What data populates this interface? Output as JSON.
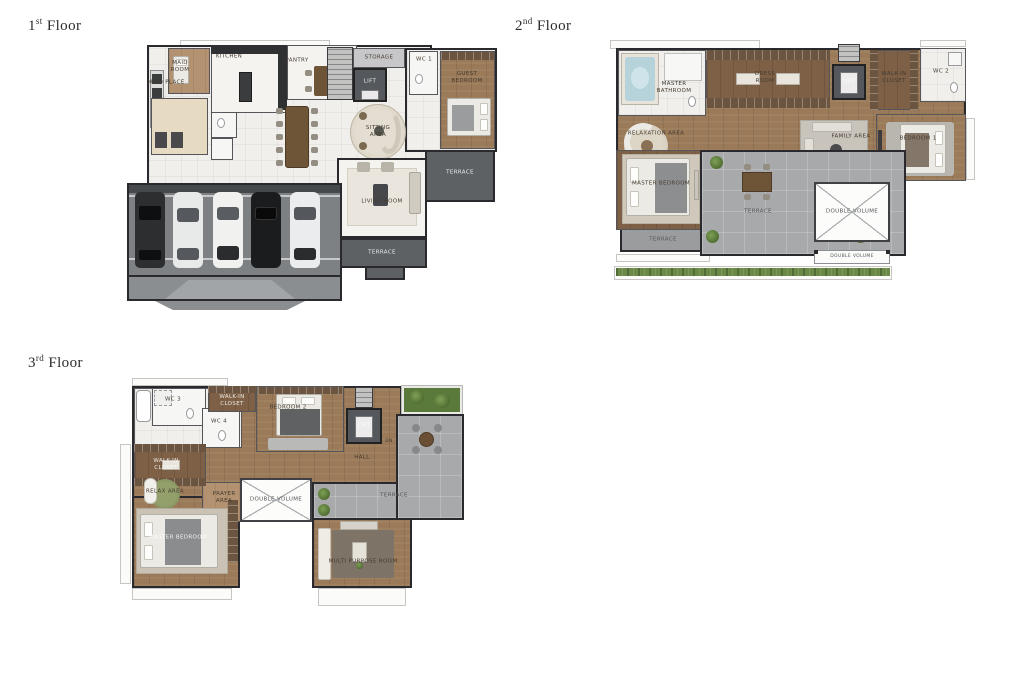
{
  "colors": {
    "background": "#ffffff",
    "wall": "#2a2a2e",
    "wood_floor": "#9a7a58",
    "wood_dark": "#7d6045",
    "tile_floor": "#f0efeb",
    "terrace_dark": "#5d6164",
    "terrace_light": "#a7a9ab",
    "road": "#7e8184",
    "greenery": "#6b8947",
    "jacuzzi_water": "#b6d3dc"
  },
  "floors": [
    {
      "title": {
        "number": "1",
        "ordinal": "st",
        "word": "Floor"
      },
      "rooms": [
        {
          "label": "MAID ROOM"
        },
        {
          "label": "KITCHEN"
        },
        {
          "label": "PANTRY"
        },
        {
          "label": "MAID PLACE"
        },
        {
          "label": "STORAGE"
        },
        {
          "label": "LIFT"
        },
        {
          "label": "WC 1"
        },
        {
          "label": "GUEST BEDROOM"
        },
        {
          "label": "TERRACE"
        },
        {
          "label": "SITTING AREA"
        },
        {
          "label": "LIVING ROOM"
        },
        {
          "label": "TERRACE"
        }
      ]
    },
    {
      "title": {
        "number": "2",
        "ordinal": "nd",
        "word": "Floor"
      },
      "rooms": [
        {
          "label": "MASTER BATHROOM"
        },
        {
          "label": "DRESS ROOM"
        },
        {
          "label": "LIFT"
        },
        {
          "label": "WALK-IN CLOSET"
        },
        {
          "label": "WC 2"
        },
        {
          "label": "BEDROOM 1"
        },
        {
          "label": "FAMILY AREA"
        },
        {
          "label": "RELAXATION AREA"
        },
        {
          "label": "MASTER BEDROOM"
        },
        {
          "label": "TERRACE"
        },
        {
          "label": "TERRACE"
        },
        {
          "label": "DOUBLE VOLUME"
        },
        {
          "label": "DOUBLE VOLUME"
        }
      ]
    },
    {
      "title": {
        "number": "3",
        "ordinal": "rd",
        "word": "Floor"
      },
      "rooms": [
        {
          "label": "WC 3"
        },
        {
          "label": "WC 4"
        },
        {
          "label": "WALK-IN CLOSET"
        },
        {
          "label": "BEDROOM 2"
        },
        {
          "label": "LIFT"
        },
        {
          "label": "DN"
        },
        {
          "label": "TERRACE"
        },
        {
          "label": "HALL"
        },
        {
          "label": "PRAYER AREA"
        },
        {
          "label": "DOUBLE VOLUME"
        },
        {
          "label": "WALK-IN CLOSET"
        },
        {
          "label": "RELAX AREA"
        },
        {
          "label": "MASTER BEDROOM"
        },
        {
          "label": "MULTI PURPOSE ROOM"
        }
      ]
    }
  ]
}
